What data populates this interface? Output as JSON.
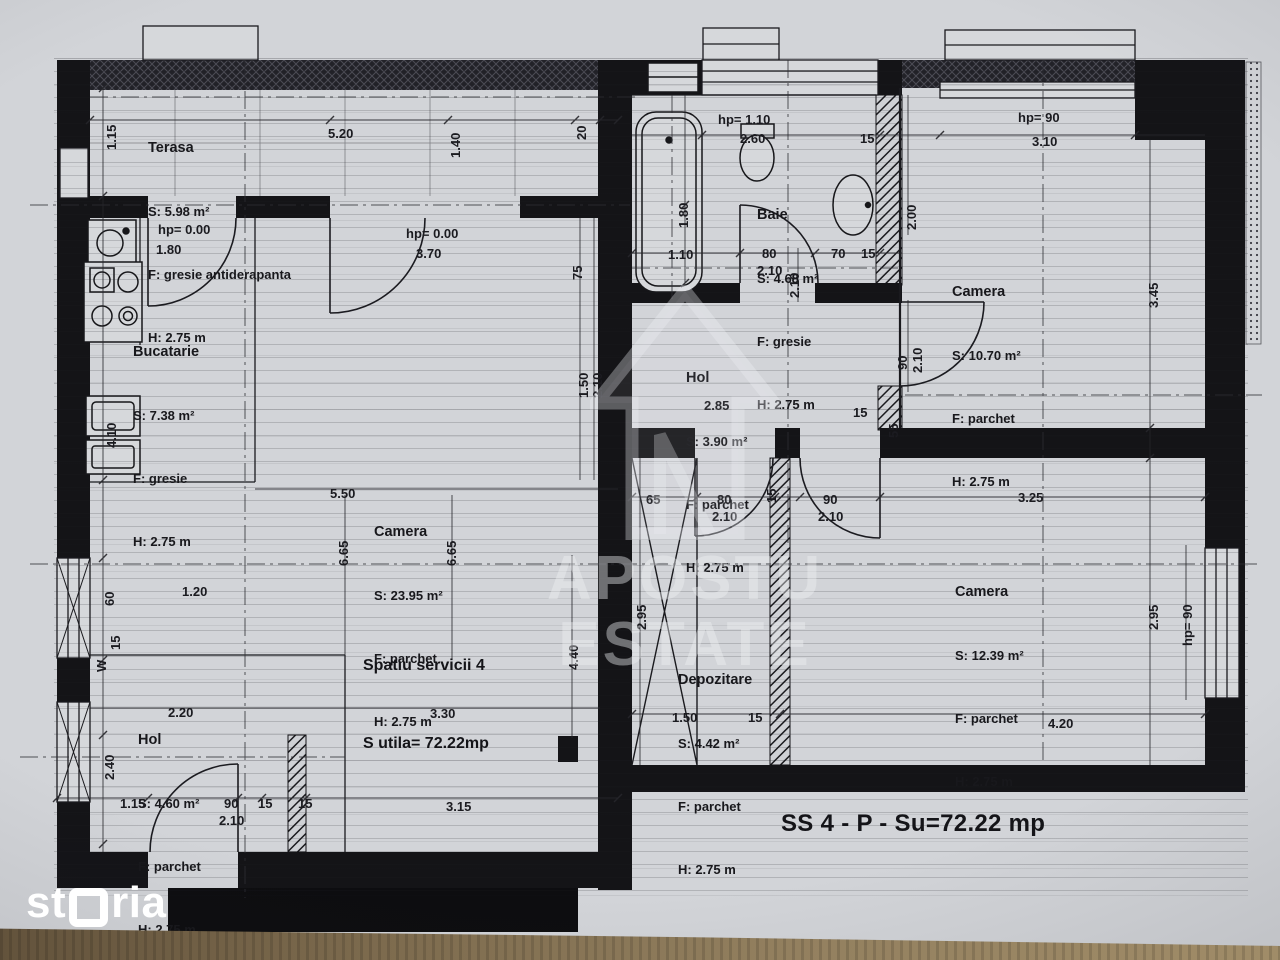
{
  "page": {
    "plan_title": "SS 4 - P - Su=72.22 mp",
    "brand_prefix": "st",
    "brand_suffix": "ria",
    "watermark": {
      "line1": "APOSTU",
      "line2": "ESTATE"
    },
    "unit": {
      "line1": "Spatiu servicii 4",
      "line2": "S utila= 72.22mp"
    }
  },
  "rooms": {
    "terasa": {
      "name": "Terasa",
      "area": "S: 5.98 m²",
      "floor": "F: gresie antiderapanta",
      "height": "H: 2.75 m"
    },
    "bucatarie": {
      "name": "Bucatarie",
      "area": "S: 7.38 m²",
      "floor": "F: gresie",
      "height": "H: 2.75 m"
    },
    "camera_mare": {
      "name": "Camera",
      "area": "S: 23.95 m²",
      "floor": "F: parchet",
      "height": "H: 2.75 m"
    },
    "hol_stanga": {
      "name": "Hol",
      "area": "S: 4.60 m²",
      "floor": "F: parchet",
      "height": "H: 2.75 m"
    },
    "baie": {
      "name": "Baie",
      "area": "S: 4.68 m²",
      "floor": "F: gresie",
      "height": "H: 2.75 m"
    },
    "hol_dreapta": {
      "name": "Hol",
      "area": "S: 3.90 m²",
      "floor": "F: parchet",
      "height": "H: 2.75 m"
    },
    "camera_sus": {
      "name": "Camera",
      "area": "S: 10.70 m²",
      "floor": "F: parchet",
      "height": "H: 2.75 m"
    },
    "camera_jos": {
      "name": "Camera",
      "area": "S: 12.39 m²",
      "floor": "F: parchet",
      "height": "H: 2.75 m"
    },
    "depozitare": {
      "name": "Depozitare",
      "area": "S: 4.42 m²",
      "floor": "F: parchet",
      "height": "H: 2.75 m"
    }
  },
  "dim_labels": [
    {
      "t": "1.15",
      "x": 104,
      "y": 150,
      "r": 1
    },
    {
      "t": "5.20",
      "x": 328,
      "y": 126
    },
    {
      "t": "1.40",
      "x": 448,
      "y": 158,
      "r": 1
    },
    {
      "t": "20",
      "x": 574,
      "y": 140,
      "r": 1
    },
    {
      "t": "hp= 0.00",
      "x": 158,
      "y": 222
    },
    {
      "t": "1.80",
      "x": 156,
      "y": 242
    },
    {
      "t": "hp= 0.00",
      "x": 406,
      "y": 226
    },
    {
      "t": "3.70",
      "x": 416,
      "y": 246
    },
    {
      "t": "75",
      "x": 570,
      "y": 280,
      "r": 1
    },
    {
      "t": "4.10",
      "x": 104,
      "y": 448,
      "r": 1
    },
    {
      "t": "1.50",
      "x": 576,
      "y": 398,
      "r": 1
    },
    {
      "t": "2.10",
      "x": 590,
      "y": 398,
      "r": 1
    },
    {
      "t": "5.50",
      "x": 330,
      "y": 486
    },
    {
      "t": "6.65",
      "x": 336,
      "y": 566,
      "r": 1
    },
    {
      "t": "6.65",
      "x": 444,
      "y": 566,
      "r": 1
    },
    {
      "t": "1.20",
      "x": 182,
      "y": 584
    },
    {
      "t": "60",
      "x": 102,
      "y": 606,
      "r": 1
    },
    {
      "t": "15",
      "x": 108,
      "y": 650,
      "r": 1
    },
    {
      "t": "W",
      "x": 94,
      "y": 672,
      "r": 1
    },
    {
      "t": "4.40",
      "x": 566,
      "y": 670,
      "r": 1
    },
    {
      "t": "2.20",
      "x": 168,
      "y": 705
    },
    {
      "t": "3.30",
      "x": 430,
      "y": 706
    },
    {
      "t": "2.40",
      "x": 102,
      "y": 780,
      "r": 1
    },
    {
      "t": "1.15",
      "x": 120,
      "y": 796
    },
    {
      "t": "90",
      "x": 224,
      "y": 796
    },
    {
      "t": "2.10",
      "x": 219,
      "y": 813
    },
    {
      "t": "15",
      "x": 258,
      "y": 796
    },
    {
      "t": "15",
      "x": 298,
      "y": 796
    },
    {
      "t": "3.15",
      "x": 446,
      "y": 799
    },
    {
      "t": "hp= 1.10",
      "x": 718,
      "y": 112
    },
    {
      "t": "2.60",
      "x": 740,
      "y": 131
    },
    {
      "t": "15",
      "x": 860,
      "y": 131
    },
    {
      "t": "1.80",
      "x": 676,
      "y": 228,
      "r": 1
    },
    {
      "t": "1.10",
      "x": 668,
      "y": 247
    },
    {
      "t": "80",
      "x": 762,
      "y": 246
    },
    {
      "t": "2.10",
      "x": 757,
      "y": 263
    },
    {
      "t": "70",
      "x": 831,
      "y": 246
    },
    {
      "t": "15",
      "x": 861,
      "y": 246
    },
    {
      "t": "2.10",
      "x": 787,
      "y": 298,
      "r": 1
    },
    {
      "t": "hp= 90",
      "x": 1018,
      "y": 110
    },
    {
      "t": "3.10",
      "x": 1032,
      "y": 134
    },
    {
      "t": "2.00",
      "x": 904,
      "y": 230,
      "r": 1
    },
    {
      "t": "3.45",
      "x": 1146,
      "y": 308,
      "r": 1
    },
    {
      "t": "90",
      "x": 895,
      "y": 370,
      "r": 1
    },
    {
      "t": "2.10",
      "x": 910,
      "y": 373,
      "r": 1
    },
    {
      "t": "2.85",
      "x": 704,
      "y": 398
    },
    {
      "t": "15",
      "x": 853,
      "y": 405
    },
    {
      "t": "55",
      "x": 886,
      "y": 438,
      "r": 1
    },
    {
      "t": "65",
      "x": 646,
      "y": 492
    },
    {
      "t": "80",
      "x": 717,
      "y": 492
    },
    {
      "t": "2.10",
      "x": 712,
      "y": 509
    },
    {
      "t": "90",
      "x": 823,
      "y": 492
    },
    {
      "t": "2.10",
      "x": 818,
      "y": 509
    },
    {
      "t": "15",
      "x": 764,
      "y": 503,
      "r": 1
    },
    {
      "t": "3.25",
      "x": 1018,
      "y": 490
    },
    {
      "t": "2.95",
      "x": 1146,
      "y": 630,
      "r": 1
    },
    {
      "t": "hp= 90",
      "x": 1180,
      "y": 646,
      "r": 1
    },
    {
      "t": "2.95",
      "x": 634,
      "y": 630,
      "r": 1
    },
    {
      "t": "1.50",
      "x": 672,
      "y": 710
    },
    {
      "t": "15",
      "x": 748,
      "y": 710
    },
    {
      "t": "4.20",
      "x": 1048,
      "y": 716
    }
  ],
  "colors": {
    "ink": "#18181c",
    "paper": "#d2d4d8",
    "wall": "#141417",
    "wood": "#7d6b4e"
  }
}
